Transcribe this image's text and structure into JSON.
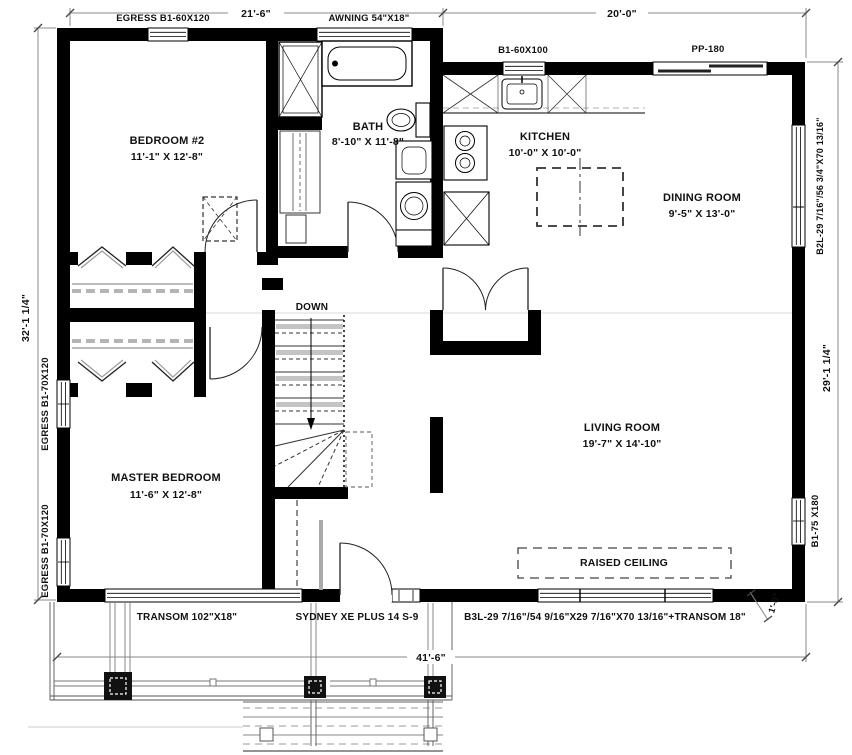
{
  "plan": {
    "dimensions": {
      "top_left": "21'-6\"",
      "top_right": "20'-0\"",
      "left": "32'-1 1/4\"",
      "right": "29'-1 1/4\"",
      "bottom": "41'-6\"",
      "porch_offset": "1'-0\""
    },
    "rooms": {
      "bedroom2": {
        "name": "BEDROOM #2",
        "size": "11'-1\" X 12'-8\""
      },
      "bath": {
        "name": "BATH",
        "size": "8'-10\" X 11'-8\""
      },
      "kitchen": {
        "name": "KITCHEN",
        "size": "10'-0\" X 10'-0\""
      },
      "dining": {
        "name": "DINING ROOM",
        "size": "9'-5\" X 13'-0\""
      },
      "master": {
        "name": "MASTER BEDROOM",
        "size": "11'-6\" X 12'-8\""
      },
      "living": {
        "name": "LIVING ROOM",
        "size": "19'-7\" X 14'-10\""
      }
    },
    "openings": {
      "egress_top": "EGRESS B1-60X120",
      "awning": "AWNING 54\"X18\"",
      "kitchen_window": "B1-60X100",
      "patio_door": "PP-180",
      "egress_left_upper": "EGRESS B1-70X120",
      "egress_left_lower": "EGRESS B1-70X120",
      "dining_window": "B2L-29 7/16\"/56 3/4\"X70 13/16\"",
      "living_window": "B1-75 X180",
      "transom": "TRANSOM 102\"X18\"",
      "front_door": "SYDNEY XE PLUS 14 S-9",
      "front_window": "B3L-29 7/16\"/54 9/16\"X29 7/16\"X70 13/16\"+TRANSOM 18\""
    },
    "annotations": {
      "stairs": "DOWN",
      "ceiling": "RAISED CEILING"
    },
    "colors": {
      "wall": "#000000",
      "dim_line": "#888888"
    }
  }
}
